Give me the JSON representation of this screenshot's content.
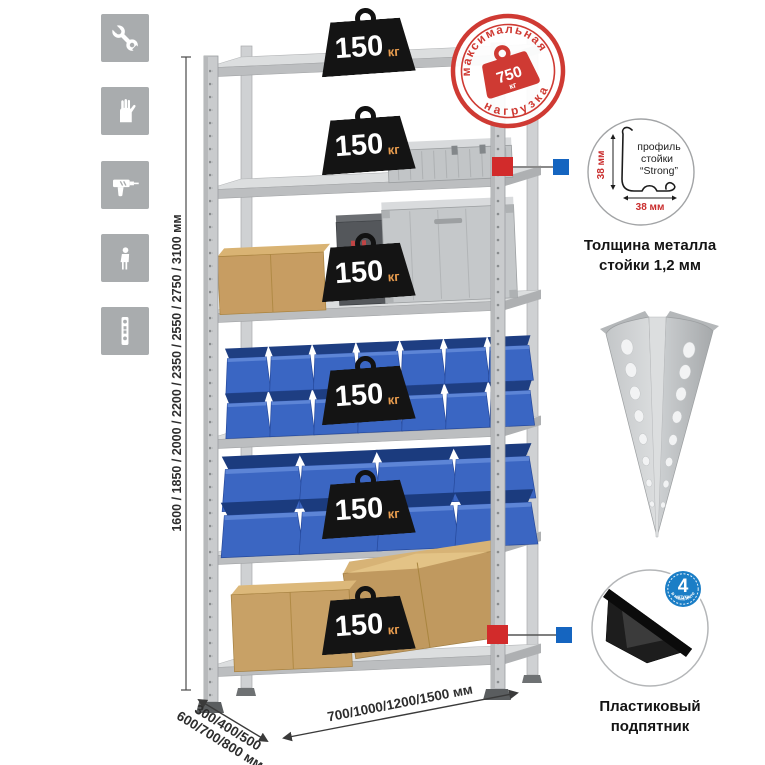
{
  "stamp": {
    "arc_top": "максимальная",
    "arc_bottom": "нагрузка",
    "value": "750",
    "unit": "кг"
  },
  "rack": {
    "badge_value": "150",
    "badge_unit": "кг",
    "shelf_count": 6
  },
  "dimensions": {
    "height": "1600 / 1850 / 2000 / 2200 / 2350 / 2550 / 2750 / 3100 мм",
    "depth_line1": "300/400/500",
    "depth_line2": "600/700/800 мм",
    "width": "700/1000/1200/1500 мм"
  },
  "profile_detail": {
    "dim_v": "38 мм",
    "dim_h": "38 мм",
    "label1": "профиль",
    "label2": "стойки",
    "label3": "“Strong”",
    "caption1": "Толщина металла",
    "caption2": "стойки 1,2 мм"
  },
  "foot_detail": {
    "badge_number": "4",
    "badge_sub": "штуки",
    "badge_arc": "в комплекте",
    "caption1": "Пластиковый",
    "caption2": "подпятник"
  },
  "icons": {
    "list": [
      "wrench-icon",
      "gloves-icon",
      "drill-icon",
      "person-icon",
      "upright-profile-icon"
    ]
  },
  "colors": {
    "stamp_red": "#cf3a33",
    "marker_red": "#d22b2b",
    "marker_blue": "#1565c0",
    "bin_blue": "#3a66c3",
    "badge_black": "#141414",
    "badge_unit_orange": "#e89c4e",
    "icon_gray": "#a9acae",
    "metal_gray": "#c9cbcd"
  }
}
